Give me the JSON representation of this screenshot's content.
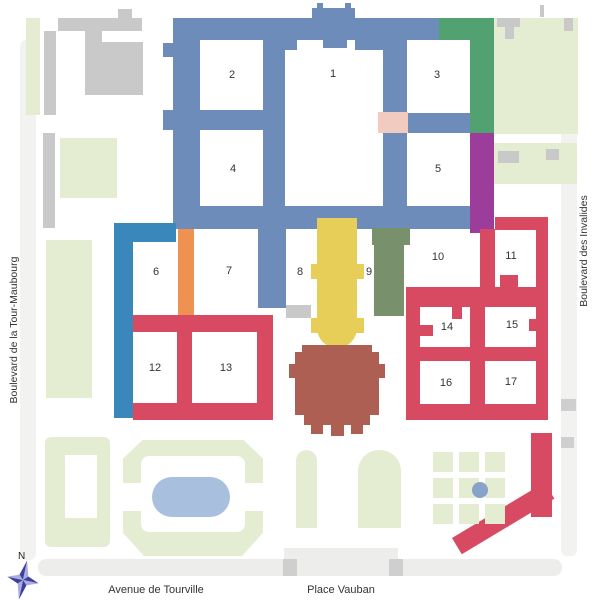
{
  "map": {
    "description": "Site plan of Les Invalides with numbered courtyards",
    "streets": {
      "west": "Boulevard de la Tour-Maubourg",
      "east": "Boulevard des Invalides",
      "south_west": "Avenue de Tourville",
      "south_east": "Place Vauban"
    },
    "compass": {
      "label": "N"
    },
    "courtyard_numbers": [
      {
        "n": "1",
        "x": 333,
        "y": 74
      },
      {
        "n": "2",
        "x": 232,
        "y": 75
      },
      {
        "n": "3",
        "x": 437,
        "y": 75
      },
      {
        "n": "4",
        "x": 233,
        "y": 169
      },
      {
        "n": "5",
        "x": 438,
        "y": 169
      },
      {
        "n": "6",
        "x": 156,
        "y": 272
      },
      {
        "n": "7",
        "x": 229,
        "y": 271
      },
      {
        "n": "8",
        "x": 300,
        "y": 272
      },
      {
        "n": "9",
        "x": 369,
        "y": 272
      },
      {
        "n": "10",
        "x": 438,
        "y": 257
      },
      {
        "n": "11",
        "x": 511,
        "y": 256
      },
      {
        "n": "12",
        "x": 155,
        "y": 368
      },
      {
        "n": "13",
        "x": 226,
        "y": 368
      },
      {
        "n": "14",
        "x": 447,
        "y": 327
      },
      {
        "n": "15",
        "x": 512,
        "y": 325
      },
      {
        "n": "16",
        "x": 446,
        "y": 383
      },
      {
        "n": "17",
        "x": 511,
        "y": 382
      }
    ],
    "colors": {
      "steel": "#6e8cba",
      "bright": "#3a87bb",
      "green": "#52a171",
      "purple": "#9c3d9c",
      "pink": "#f2cbc0",
      "orange": "#ef9150",
      "sage": "#78906c",
      "yellow": "#e7ce58",
      "brown": "#ae5f54",
      "red": "#d84a62",
      "lawn": "#e4ecd2",
      "gray": "#c9c9c9",
      "grayd": "#cfcfcf",
      "street": "#ededeb",
      "streetlight": "#f2f2f1",
      "pond": "#a9bfde",
      "fountain": "#87a3c9",
      "ink": "#333333",
      "compass_dark": "#403e9e",
      "compass_light": "#a8aede"
    }
  }
}
